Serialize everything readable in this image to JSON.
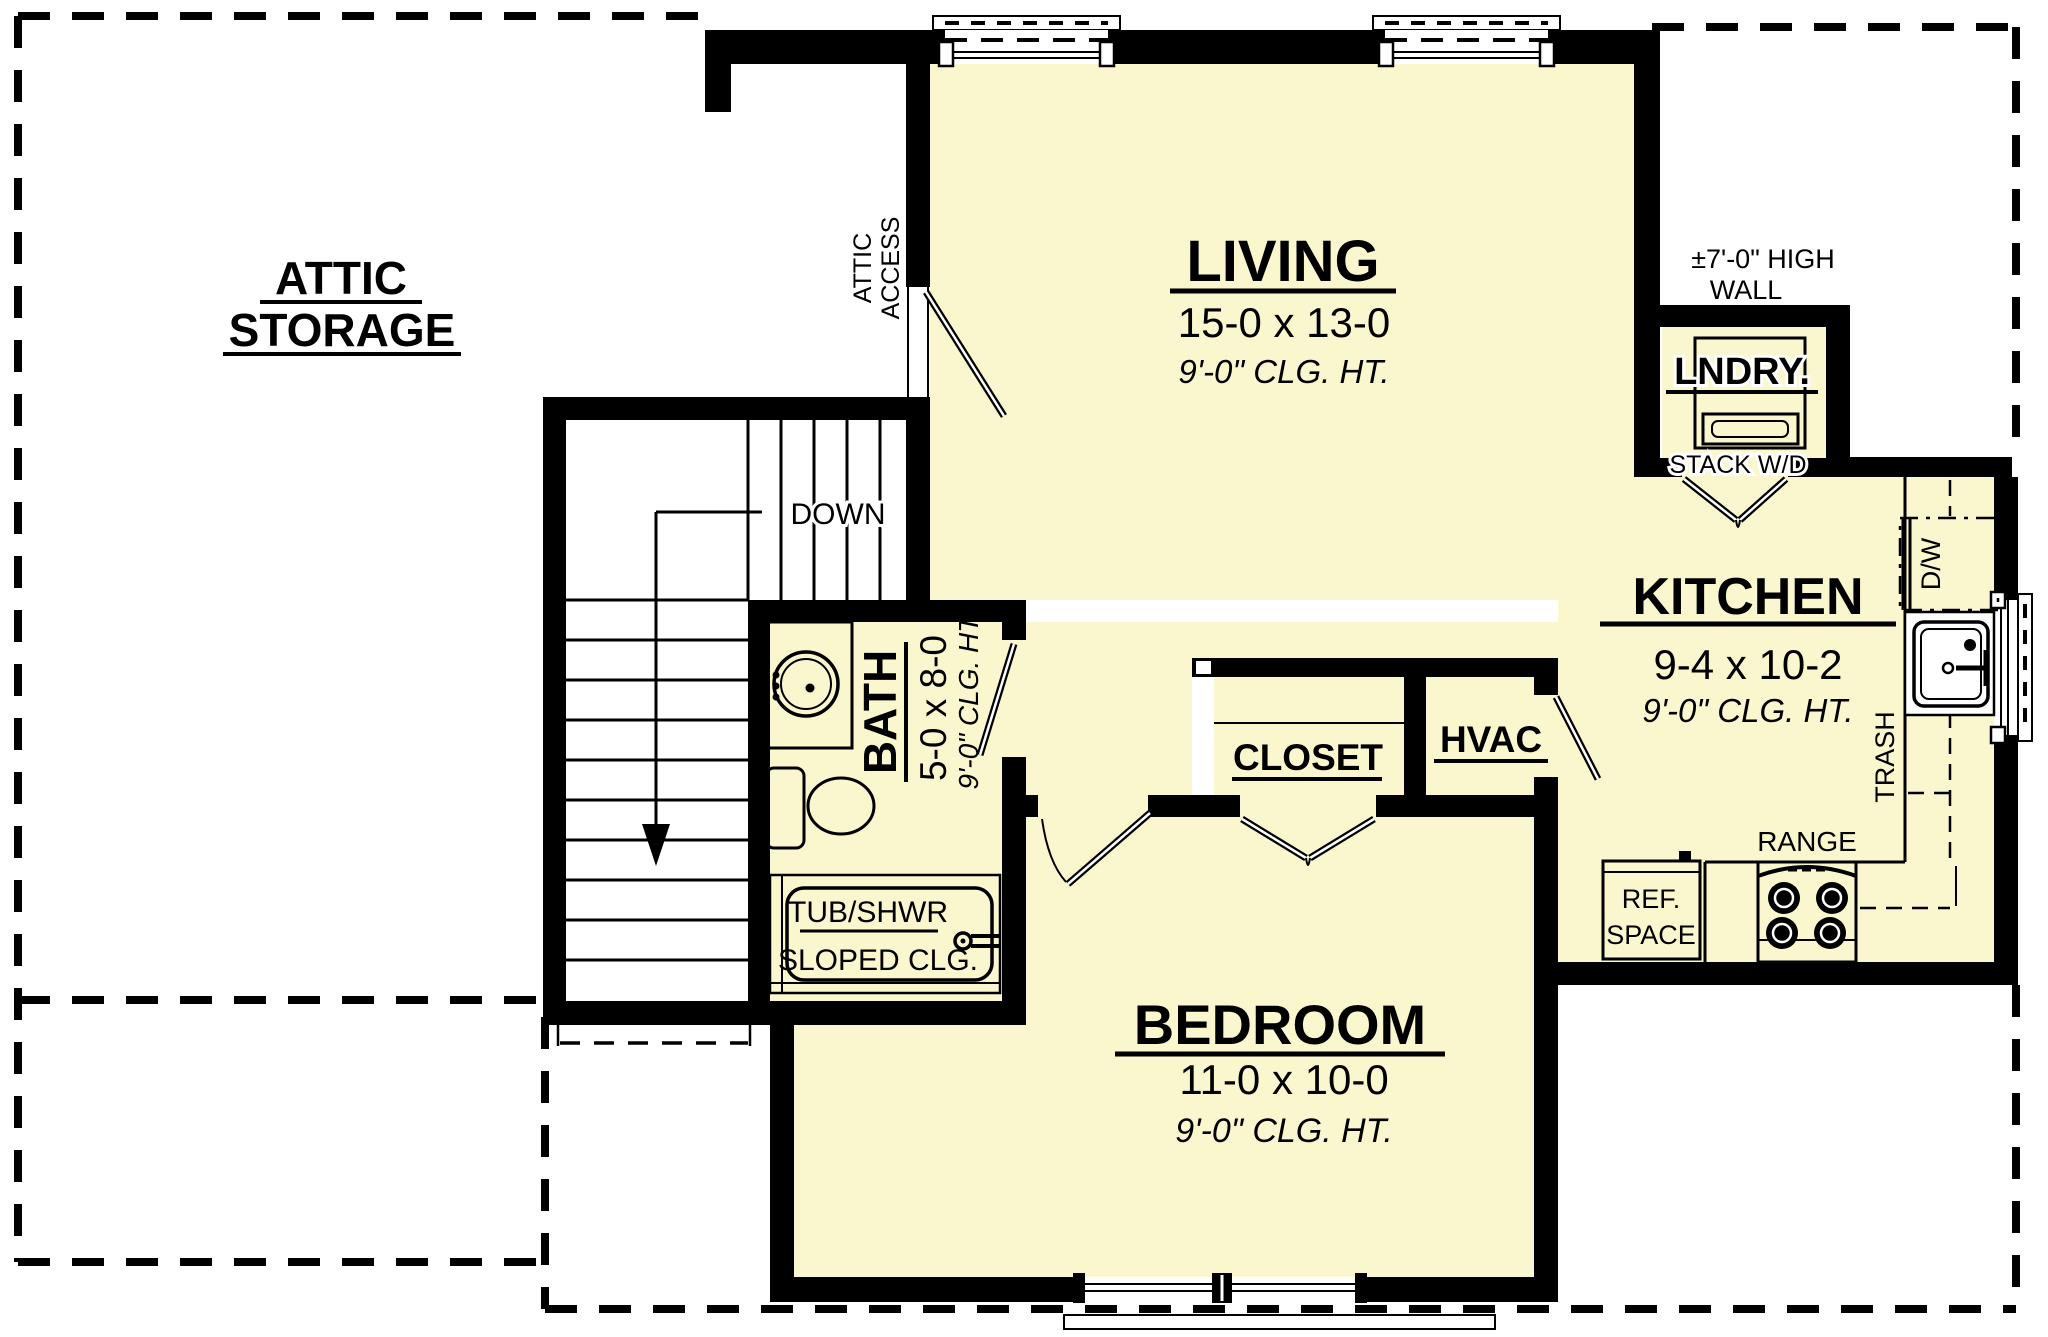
{
  "colors": {
    "room_fill": "#faf6cd",
    "wall": "#000000",
    "line": "#000000",
    "background": "#ffffff"
  },
  "rooms": {
    "attic_storage": {
      "line1": "ATTIC",
      "line2": "STORAGE"
    },
    "living": {
      "name": "LIVING",
      "dims": "15-0 x 13-0",
      "ceiling": "9'-0\" CLG. HT."
    },
    "kitchen": {
      "name": "KITCHEN",
      "dims": "9-4 x 10-2",
      "ceiling": "9'-0\" CLG. HT."
    },
    "bedroom": {
      "name": "BEDROOM",
      "dims": "11-0 x 10-0",
      "ceiling": "9'-0\" CLG. HT."
    },
    "bath": {
      "name": "BATH",
      "dims": "5-0 x 8-0",
      "ceiling": "9'-0\" CLG. HT."
    },
    "laundry": {
      "name": "LNDRY.",
      "note": "STACK W/D"
    },
    "closet": {
      "name": "CLOSET"
    },
    "hvac": {
      "name": "HVAC"
    }
  },
  "annotations": {
    "down": "DOWN",
    "attic_access_line1": "ATTIC",
    "attic_access_line2": "ACCESS",
    "high_wall_line1": "±7'-0\" HIGH",
    "high_wall_line2": "WALL",
    "tub": "TUB/SHWR",
    "sloped": "SLOPED CLG.",
    "dishwasher": "D/W",
    "trash": "TRASH",
    "range": "RANGE",
    "ref_line1": "REF.",
    "ref_line2": "SPACE"
  }
}
